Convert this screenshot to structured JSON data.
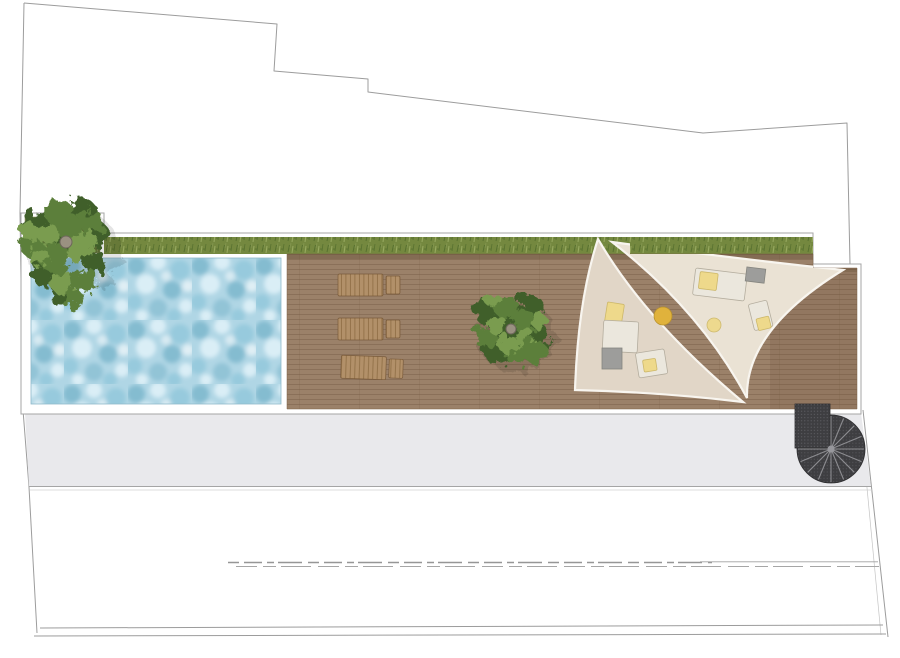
{
  "meta": {
    "description": "Top-down architectural landscape plan of a long roof terrace",
    "view": "plan view, no readable text (one blurred dashed watermark row near bottom)"
  },
  "features": {
    "pool": "rectangular swimming pool with mottled water texture, left end of terrace",
    "planter": "square planter with large shrub at top-left corner of pool",
    "lawn_strip": "narrow green lawn band along the top edge of the terrace",
    "deck": "wooden plank deck occupying centre and right of terrace",
    "sun_loungers": 3,
    "trees": 2,
    "shade_sails": 2,
    "lounge_furniture": "two seating groups with yellow cushions, grey side tables, two round yellow ottomans",
    "spiral_staircase": 1,
    "walkway": "light grey band running below the terrace",
    "blurred_text": "illegible dashed grey row near bottom of sheet",
    "boundary": "thin grey irregular property outline around the sheet"
  },
  "colors": {
    "boundary": "#9c9c9c",
    "outline": "#a5a5a5",
    "white": "#ffffff",
    "grass_base": "#74883f",
    "grass_dark": "#57702f",
    "grass_light": "#99ab62",
    "grass_mid": "#83964f",
    "tree_dark": "#3f5f2c",
    "tree_mid": "#5c7f3b",
    "tree_light": "#7a9c50",
    "tree_trunk": "#9a9181",
    "water_base": "#b0d6e5",
    "water_dark": "#84bcd0",
    "water_mid": "#97cadd",
    "water_light": "#daeef6",
    "deck_base": "#9b8169",
    "deck_line": "#6e543d",
    "deck_dark": "#6b4f37",
    "sail_left": "#e1d6c7",
    "sail_right": "#eae2d4",
    "sail_edge": "#f8f5ef",
    "lounger_wood": "#b29069",
    "lounger_slat": "#87673f",
    "furn_light": "#ebe7dd",
    "furn_yellow": "#eed98b",
    "furn_deep_yellow": "#e0b23c",
    "furn_gray": "#9d9d9b",
    "furn_outline": "#b4ad9e",
    "stair_dark": "#3e3e41",
    "stair_spoke": "#8c8c90",
    "stair_hub": "#97979c",
    "stair_dot": "#73737a",
    "band_gray": "#e9e9ec",
    "dash": "#969696"
  }
}
